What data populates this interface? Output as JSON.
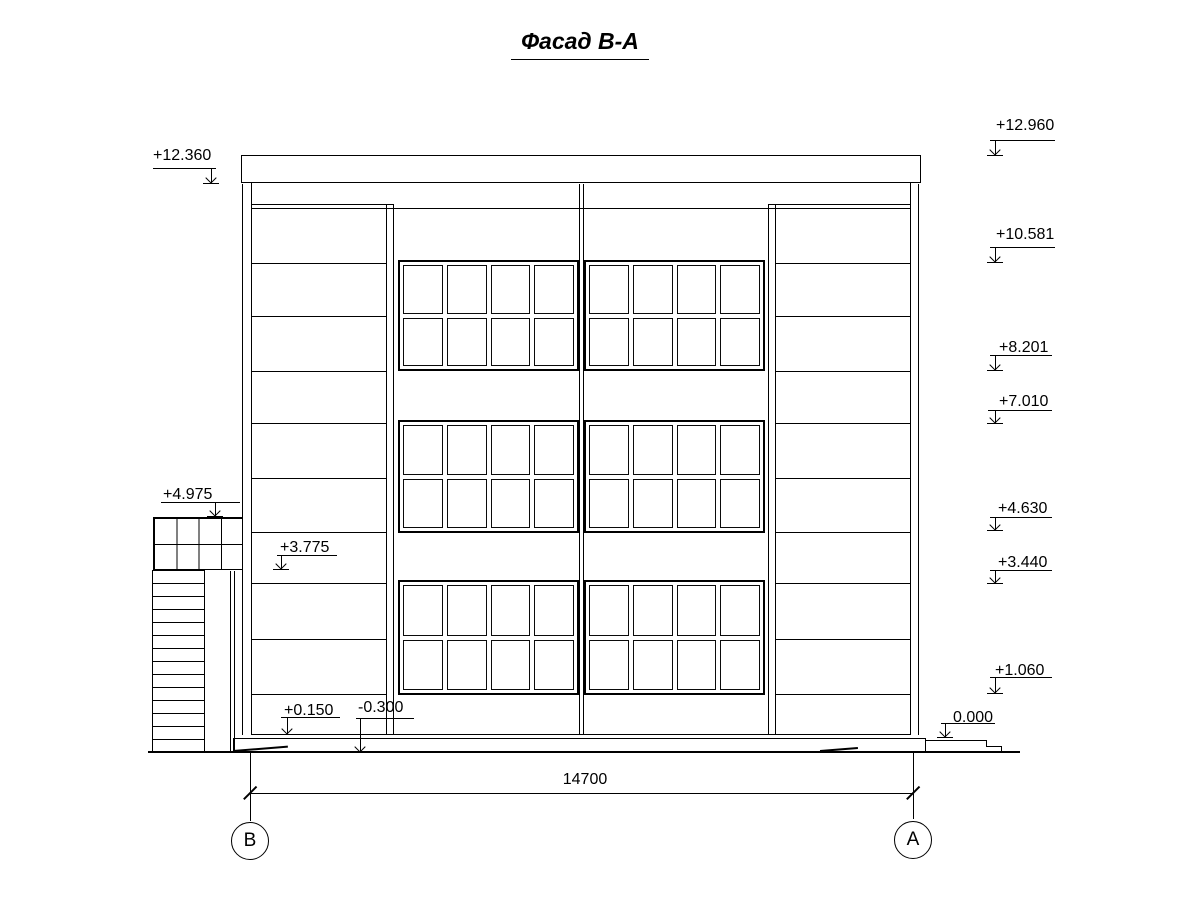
{
  "title": "Фасад В-А",
  "drawing": {
    "type": "architectural-facade-elevation",
    "axis_labels": {
      "left": "В",
      "right": "А"
    },
    "overall_dimension": "14700",
    "elevation_marks_left": [
      "+12.360",
      "+4.975",
      "+3.775",
      "+0.150",
      "-0.300"
    ],
    "elevation_marks_right": [
      "+12.960",
      "+10.581",
      "+8.201",
      "+7.010",
      "+4.630",
      "+3.440",
      "+1.060",
      "0.000"
    ],
    "windows": {
      "sections": 2,
      "floors": 3,
      "columns_per_section": 4,
      "rows_per_floor": 2
    },
    "colors": {
      "line": "#000000",
      "background": "#ffffff"
    }
  }
}
